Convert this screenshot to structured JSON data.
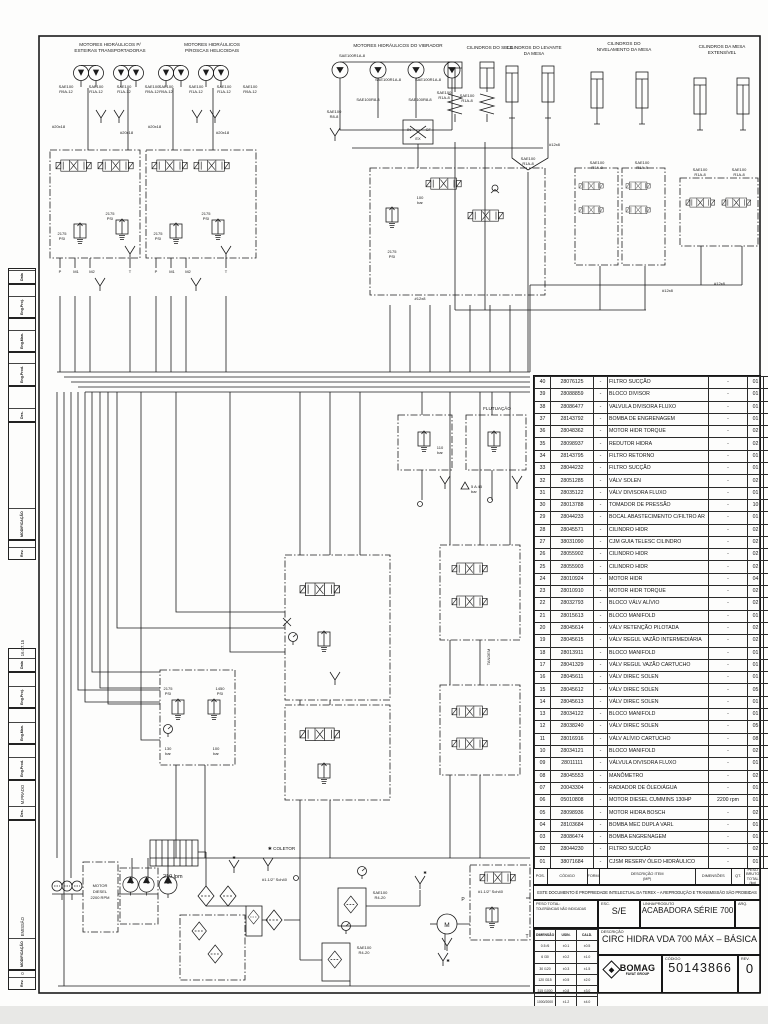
{
  "groups": {
    "esteiras": {
      "l1": "MOTORES HIDRÁULICOS P/",
      "l2": "ESTEIRAS TRANSPORTADORAS"
    },
    "roscas": {
      "l1": "MOTORES HIDRÁULICOS",
      "l2": "P/ROSCAS HELICOIDAIS"
    },
    "vibrador": {
      "l1": "MOTORES HIDRÁULICOS DO VIBRADOR"
    },
    "selo": {
      "l1": "CILINDROS DO SELO"
    },
    "levante": {
      "l1": "CILINDROS DO LEVANTE",
      "l2": "DA MESA"
    },
    "nivelamento": {
      "l1": "CILINDROS DO",
      "l2": "NIVELAMENTO DA MESA"
    },
    "extensivel": {
      "l1": "CILINDROS DA MESA",
      "l2": "EXTENSÍVEL"
    }
  },
  "hoses": {
    "sae100": "SAE100",
    "r9a12": "R9A-12",
    "r1a12": "R1A-12",
    "r1a8": "R1A-8",
    "r8_8": "R8-8",
    "r4_20": "R4-20",
    "sae100r1a8": "SAE100R1A-8",
    "sae100r8_8": "SAE100R8-8",
    "d20x18": "#20x18",
    "d12x8": "#12x8"
  },
  "labels": {
    "coletor": "✱ COLETOR",
    "sch40": "#1.1/2\" Sch40",
    "star": "✱",
    "in": "IN",
    "cf": "CF",
    "ex": "EX",
    "p": "P",
    "t": "T",
    "m": "M",
    "flutuacao": "FLUTUAÇÃO",
    "tandem": "TANDEM",
    "delta": "5 A 45"
  },
  "pressures": {
    "v2175": "2175",
    "psi": "PSI",
    "v1450": "1450",
    "bar": "bar",
    "v110": "110",
    "v100": "100",
    "v130": "130"
  },
  "ports": {
    "p": "P",
    "m1": "M1",
    "m2": "M2",
    "t": "T"
  },
  "motor_box": {
    "l1": "MOTOR",
    "l2": "DIESEL",
    "l3": "2200 RPM"
  },
  "flow210": "210 lpm",
  "flows": [
    "7 lpm",
    "40 lpm",
    "40 lpm",
    "60 lpm",
    "40 lpm",
    "24 lpm",
    "16 lpm",
    "80 lpm",
    "40 lpm"
  ],
  "balloons": [
    "36",
    "35",
    "23",
    "24",
    "24",
    "31",
    "28",
    "28",
    "25",
    "25",
    "26",
    "26",
    "27",
    "27",
    "12",
    "12",
    "12",
    "12",
    "11",
    "11",
    "10",
    "10",
    "30",
    "30",
    "11",
    "14",
    "15",
    "17",
    "16",
    "13",
    "30",
    "30",
    "22",
    "11",
    "30",
    "22",
    "11",
    "30",
    "35",
    "34",
    "09",
    "30",
    "30",
    "12",
    "12",
    "12",
    "12",
    "10",
    "19",
    "20",
    "08",
    "06",
    "04",
    "03",
    "38",
    "29",
    "01",
    "40",
    "33",
    "34",
    "07",
    "02",
    "02",
    "05",
    "32",
    "37"
  ],
  "parts_table": {
    "headers": {
      "pos": "POS.",
      "codigo": "CÓDIGO",
      "form": "FORM.",
      "desc": "DESCRIÇÃO ITEM",
      "desc2": "(MP)",
      "dim": "DIMENSÕES",
      "qt": "QT.",
      "peso": "PESO BRUTO",
      "peso2": "TOTAL (kg)"
    },
    "rows": [
      {
        "pos": "40",
        "code": "28076125",
        "form": "-",
        "desc": "FILTRO SUCÇÃO",
        "dim": "-",
        "qty": "01"
      },
      {
        "pos": "39",
        "code": "28088859",
        "form": "-",
        "desc": "BLOCO DIVISOR",
        "dim": "-",
        "qty": "01"
      },
      {
        "pos": "38",
        "code": "28086477",
        "form": "-",
        "desc": "VALVULA DIVISORA FLUXO",
        "dim": "-",
        "qty": "01"
      },
      {
        "pos": "37",
        "code": "28143792",
        "form": "-",
        "desc": "BOMBA DE ENGRENAGEM",
        "dim": "-",
        "qty": "01"
      },
      {
        "pos": "36",
        "code": "28048362",
        "form": "-",
        "desc": "MOTOR HIDR TORQUE",
        "dim": "-",
        "qty": "02"
      },
      {
        "pos": "35",
        "code": "28098937",
        "form": "-",
        "desc": "REDUTOR HIDRA",
        "dim": "-",
        "qty": "02"
      },
      {
        "pos": "34",
        "code": "28143795",
        "form": "-",
        "desc": "FILTRO RETORNO",
        "dim": "-",
        "qty": "01"
      },
      {
        "pos": "33",
        "code": "28044232",
        "form": "-",
        "desc": "FILTRO SUCÇÃO",
        "dim": "-",
        "qty": "01"
      },
      {
        "pos": "32",
        "code": "28051285",
        "form": "-",
        "desc": "VÁLV  SOLEN",
        "dim": "-",
        "qty": "02"
      },
      {
        "pos": "31",
        "code": "28035122",
        "form": "-",
        "desc": "VÁLV DIVISORA FLUXO",
        "dim": "-",
        "qty": "01"
      },
      {
        "pos": "30",
        "code": "28013788",
        "form": "-",
        "desc": "TOMADOR DE PRESSÃO",
        "dim": "-",
        "qty": "10"
      },
      {
        "pos": "29",
        "code": "28044233",
        "form": "-",
        "desc": "BOCAL ABASTECIMENTO C/FILTRO AR",
        "dim": "-",
        "qty": "01"
      },
      {
        "pos": "28",
        "code": "28045571",
        "form": "-",
        "desc": "CILINDRO HIDR",
        "dim": "-",
        "qty": "02"
      },
      {
        "pos": "27",
        "code": "38031090",
        "form": "-",
        "desc": "CJM GUIA TELESC CILINDRO",
        "dim": "-",
        "qty": "02"
      },
      {
        "pos": "26",
        "code": "28055902",
        "form": "-",
        "desc": "CILINDRO HIDR",
        "dim": "-",
        "qty": "02"
      },
      {
        "pos": "25",
        "code": "28055903",
        "form": "-",
        "desc": "CILINDRO HIDR",
        "dim": "-",
        "qty": "02"
      },
      {
        "pos": "24",
        "code": "28010924",
        "form": "-",
        "desc": "MOTOR HIDR",
        "dim": "-",
        "qty": "04"
      },
      {
        "pos": "23",
        "code": "28010910",
        "form": "-",
        "desc": "MOTOR HIDR TORQUE",
        "dim": "-",
        "qty": "02"
      },
      {
        "pos": "22",
        "code": "28032793",
        "form": "-",
        "desc": "BLOCO VÁLV ALÍVIO",
        "dim": "-",
        "qty": "02"
      },
      {
        "pos": "21",
        "code": "28015613",
        "form": "-",
        "desc": "BLOCO MANIFOLD",
        "dim": "-",
        "qty": "01"
      },
      {
        "pos": "20",
        "code": "28045614",
        "form": "-",
        "desc": "VÁLV RETENÇÃO PILOTADA",
        "dim": "-",
        "qty": "02"
      },
      {
        "pos": "19",
        "code": "28045615",
        "form": "-",
        "desc": "VÁLV REGUL VAZÃO INTERMEDIÁRIA",
        "dim": "-",
        "qty": "02"
      },
      {
        "pos": "18",
        "code": "28013911",
        "form": "-",
        "desc": "BLOCO MANIFOLD",
        "dim": "-",
        "qty": "01"
      },
      {
        "pos": "17",
        "code": "28041329",
        "form": "-",
        "desc": "VÁLV REGUL VAZÃO CARTUCHO",
        "dim": "-",
        "qty": "01"
      },
      {
        "pos": "16",
        "code": "28045611",
        "form": "-",
        "desc": "VÁLV DIREC SOLEN",
        "dim": "-",
        "qty": "01"
      },
      {
        "pos": "15",
        "code": "28045612",
        "form": "-",
        "desc": "VÁLV DIREC SOLEN",
        "dim": "-",
        "qty": "05"
      },
      {
        "pos": "14",
        "code": "28045613",
        "form": "-",
        "desc": "VÁLV DIREC SOLEN",
        "dim": "-",
        "qty": "01"
      },
      {
        "pos": "13",
        "code": "28034122",
        "form": "-",
        "desc": "BLOCO MANIFOLD",
        "dim": "-",
        "qty": "01"
      },
      {
        "pos": "12",
        "code": "28038240",
        "form": "-",
        "desc": "VÁLV DIREC SOLEN",
        "dim": "-",
        "qty": "05"
      },
      {
        "pos": "11",
        "code": "28016916",
        "form": "-",
        "desc": "VÁLV ALÍVIO CARTUCHO",
        "dim": "-",
        "qty": "08"
      },
      {
        "pos": "10",
        "code": "28034121",
        "form": "-",
        "desc": "BLOCO MANIFOLD",
        "dim": "-",
        "qty": "02"
      },
      {
        "pos": "09",
        "code": "28011111",
        "form": "-",
        "desc": "VÁLVULA DIVISORA FLUXO",
        "dim": "-",
        "qty": "01"
      },
      {
        "pos": "08",
        "code": "28045553",
        "form": "-",
        "desc": "MANÔMETRO",
        "dim": "-",
        "qty": "02"
      },
      {
        "pos": "07",
        "code": "20043304",
        "form": "-",
        "desc": "RADIADOR DE ÓLEO/ÁGUA",
        "dim": "-",
        "qty": "01"
      },
      {
        "pos": "06",
        "code": "05010808",
        "form": "-",
        "desc": "MOTOR DIESEL CUMMINS 130HP",
        "dim": "2200 rpm",
        "qty": "01"
      },
      {
        "pos": "05",
        "code": "28098936",
        "form": "-",
        "desc": "MOTOR HIDRA BOSCH",
        "dim": "-",
        "qty": "02"
      },
      {
        "pos": "04",
        "code": "28103684",
        "form": "-",
        "desc": "BOMBA  MEC DUPLA VARL",
        "dim": "-",
        "qty": "01"
      },
      {
        "pos": "03",
        "code": "28086474",
        "form": "-",
        "desc": "BOMBA ENGRENAGEM",
        "dim": "-",
        "qty": "01"
      },
      {
        "pos": "02",
        "code": "28044230",
        "form": "-",
        "desc": "FILTRO SUCÇÃO",
        "dim": "-",
        "qty": "02"
      },
      {
        "pos": "01",
        "code": "38071684",
        "form": "-",
        "desc": "CJSM RESERV ÓLEO HIDRÁULICO",
        "dim": "-",
        "qty": "01"
      }
    ]
  },
  "disclaimer": "ESTE DOCUMENTO É PROPRIEDADE INTELECTUAL DA TEREX – A REPRODUÇÃO E TRANSMISSÃO SÃO PROIBIDAS",
  "title_block": {
    "peso_label": "PESO TOTAL:",
    "tol_label": "TOLERÂNCIAS NÃO INDICADAS",
    "esc_label": "ESC.",
    "esc_value": "S/E",
    "linha_label": "LINHA/PRODUTO",
    "linha_value": "ACABADORA SÉRIE 700",
    "arq_label": "ARQ.",
    "descricao_label": "DESCRIÇÃO",
    "descricao_value": "CIRC HIDRA VDA 700 MÁX – BÁSICA",
    "codigo_label": "CÓDIGO",
    "codigo_value": "50143866",
    "rev_label": "REV.",
    "rev_value": "0",
    "brand": "BOMAG",
    "brand_sub": "FAYAT GROUP"
  },
  "tolerance_table": {
    "headers": [
      "DIMENSÃO DE/A",
      "USIN.",
      "CALD."
    ],
    "rows": [
      [
        "0.5 /6",
        "±0.1",
        "±0.5"
      ],
      [
        "6 /30",
        "±0.2",
        "±1.0"
      ],
      [
        "30 /120",
        "±0.3",
        "±1.5"
      ],
      [
        "120 /315",
        "±0.5",
        "±2.0"
      ],
      [
        "315 /1000",
        "±0.8",
        "±3.0"
      ],
      [
        "1000/2000",
        "±1.2",
        "±4.0"
      ]
    ]
  },
  "revisions": {
    "headers": [
      "Data",
      "Eng.Proj.",
      "Eng.Man.",
      "Eng.Prod.",
      "Des.",
      "MODIFICAÇÃO",
      "Rev."
    ],
    "entry": {
      "data": "16.07.15",
      "eng_proj": "",
      "eng_man": "",
      "eng_prod": "",
      "des": "M.PRADO",
      "modificacao": "EMISSÃO",
      "rev": "0"
    }
  }
}
